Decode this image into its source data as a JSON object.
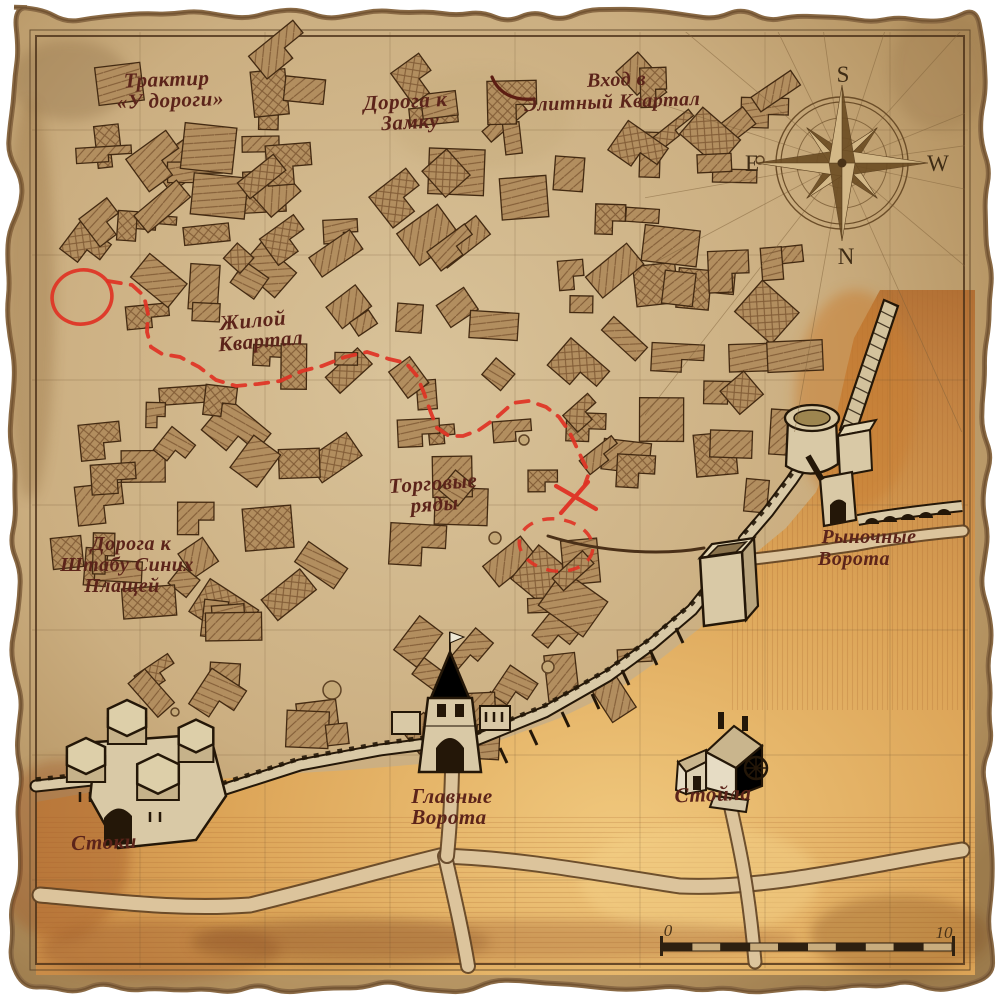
{
  "map": {
    "labels": {
      "tavern": {
        "line1": "Трактир",
        "line2": "«У дороги»"
      },
      "road_castle": {
        "line1": "Дорога к",
        "line2": "Замку"
      },
      "elite_entrance": {
        "line1": "Вход в",
        "line2": "Элитный Квартал"
      },
      "residential": {
        "line1": "Жилой",
        "line2": "Квартал"
      },
      "market_rows": {
        "line1": "Торговые",
        "line2": "ряды"
      },
      "road_hq": {
        "line1": "Дорога к",
        "line2": "Штабу Синих",
        "line3": "Плащей"
      },
      "market_gate": {
        "line1": "Рыночные",
        "line2": "Ворота"
      },
      "main_gate": {
        "line1": "Главные",
        "line2": "Ворота"
      },
      "stables": {
        "line1": "Стойла"
      },
      "sewers": {
        "line1": "Стоки"
      }
    },
    "compass": {
      "north": "N",
      "south": "S",
      "east": "E",
      "west": "W"
    },
    "scale_bar": {
      "start": "0",
      "end": "10"
    }
  },
  "colors": {
    "label": "#5c241a",
    "route": "#e03224",
    "parchment": "#cbae80",
    "parchment_light": "#d9c39a",
    "parchment_dark": "#9c7b4c",
    "terrain": "#dca457",
    "terrain_dark": "#a9662d",
    "building_fill": "#b28e5f",
    "building_line": "#7a5530",
    "outline": "#432a12",
    "ink": "#6b4f30",
    "wall_fill": "#d9c9a6",
    "wall_line": "#241708",
    "road_fill": "#dcc49c",
    "compass_ink": "#6b4d28"
  }
}
